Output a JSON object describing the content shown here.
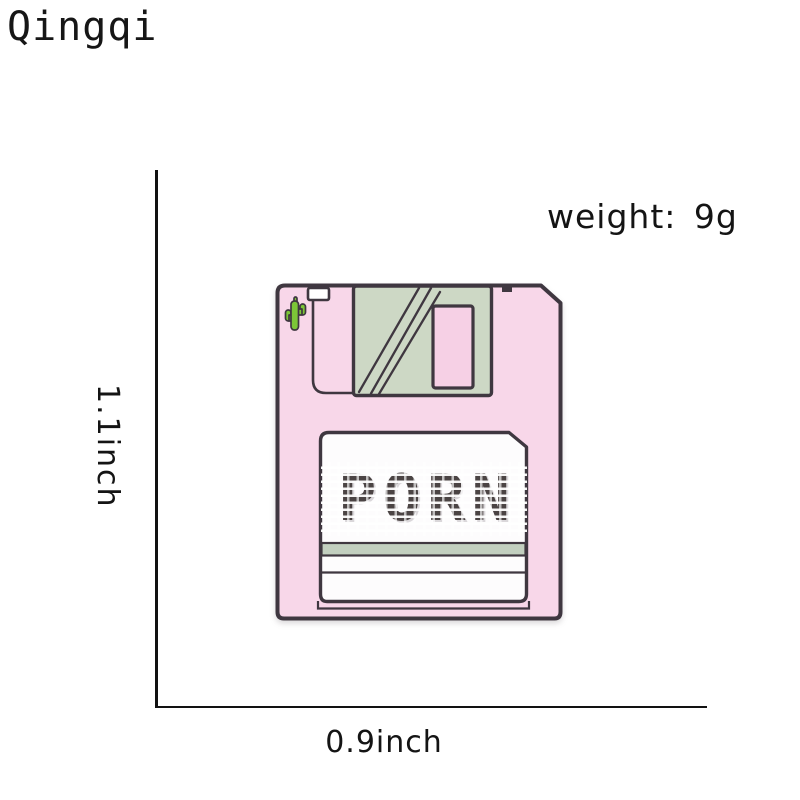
{
  "header": {
    "brand": "Qingqi"
  },
  "annotations": {
    "weight_label": "weight: 9g",
    "height_label": "1.1inch",
    "width_label": "0.9inch"
  },
  "pin": {
    "label_text": "PORN",
    "icon": "cactus-icon",
    "colors": {
      "body_pink": "#f8d7e9",
      "window_pink": "#f6d0e5",
      "shutter_green": "#cdd8c5",
      "stripe_green": "#c2cfbf",
      "cactus_green": "#7cc637",
      "outline_dark": "#3f3740",
      "label_white": "#fdfcfd",
      "text_dark": "#4b4444"
    }
  }
}
